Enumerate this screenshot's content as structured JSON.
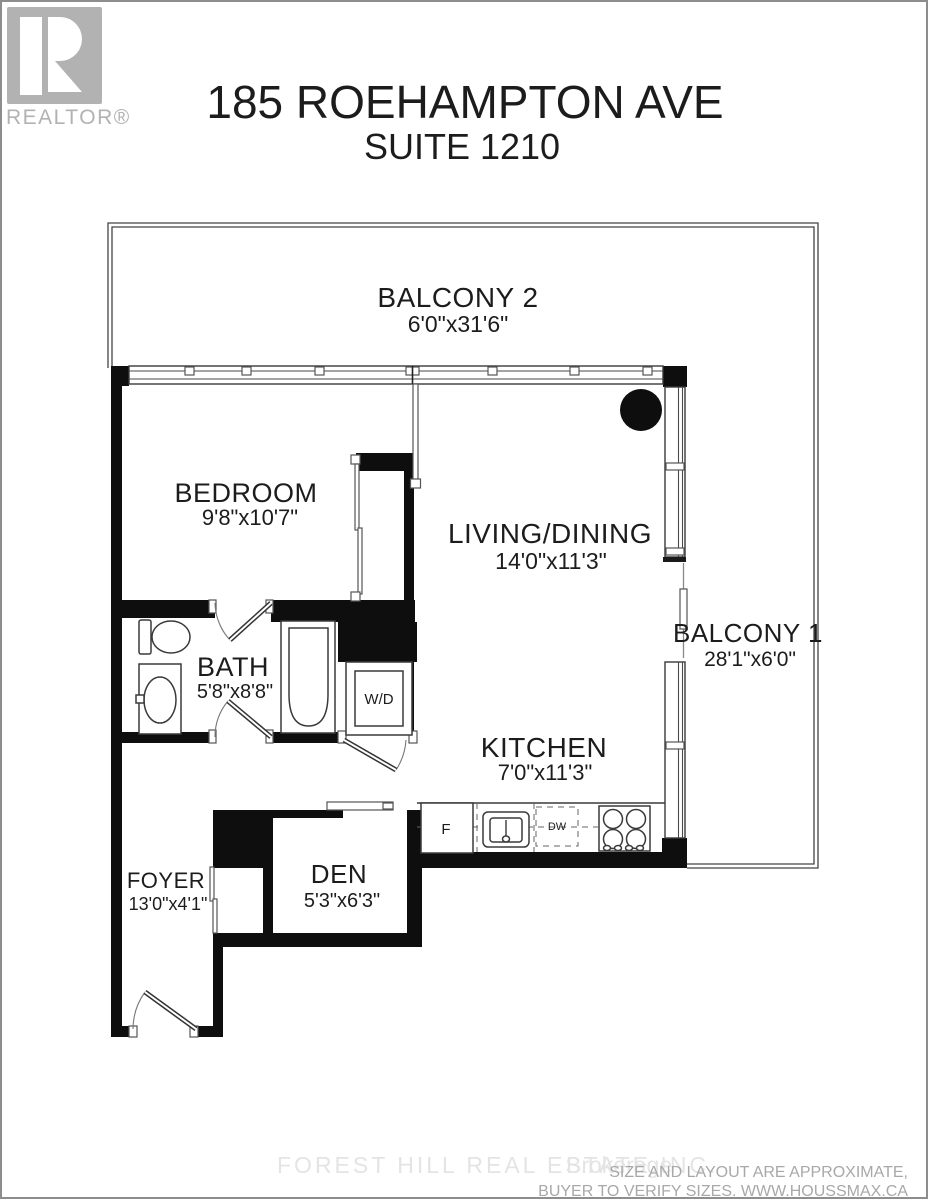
{
  "logo": {
    "letter": "R",
    "brand": "REALTOR®"
  },
  "title": {
    "line1": "185 ROEHAMPTON AVE",
    "line2": "SUITE 1210"
  },
  "rooms": {
    "balcony2": {
      "name": "BALCONY 2",
      "dims": "6'0\"x31'6\""
    },
    "bedroom": {
      "name": "BEDROOM",
      "dims": "9'8\"x10'7\""
    },
    "living": {
      "name": "LIVING/DINING",
      "dims": "14'0\"x11'3\""
    },
    "balcony1": {
      "name": "BALCONY 1",
      "dims": "28'1\"x6'0\""
    },
    "bath": {
      "name": "BATH",
      "dims": "5'8\"x8'8\""
    },
    "kitchen": {
      "name": "KITCHEN",
      "dims": "7'0\"x11'3\""
    },
    "foyer": {
      "name": "FOYER",
      "dims": "13'0\"x4'1\""
    },
    "den": {
      "name": "DEN",
      "dims": "5'3\"x6'3\""
    }
  },
  "appliances": {
    "washer_dryer": "W/D",
    "fridge": "F",
    "dishwasher": "DW"
  },
  "footer": {
    "watermark_company": "FOREST HILL REAL ESTATE INC.",
    "watermark_suffix": "Brokerage",
    "disclaimer_line1": "SIZE AND LAYOUT ARE APPROXIMATE,",
    "disclaimer_line2": "BUYER TO VERIFY SIZES. WWW.HOUSSMAX.CA"
  },
  "colors": {
    "wall": "#0e0e0e",
    "line": "#3a3a3a",
    "logo_gray": "#b2b2b2",
    "watermark": "#e4e4e4",
    "disclaimer": "#a8a8a8"
  }
}
